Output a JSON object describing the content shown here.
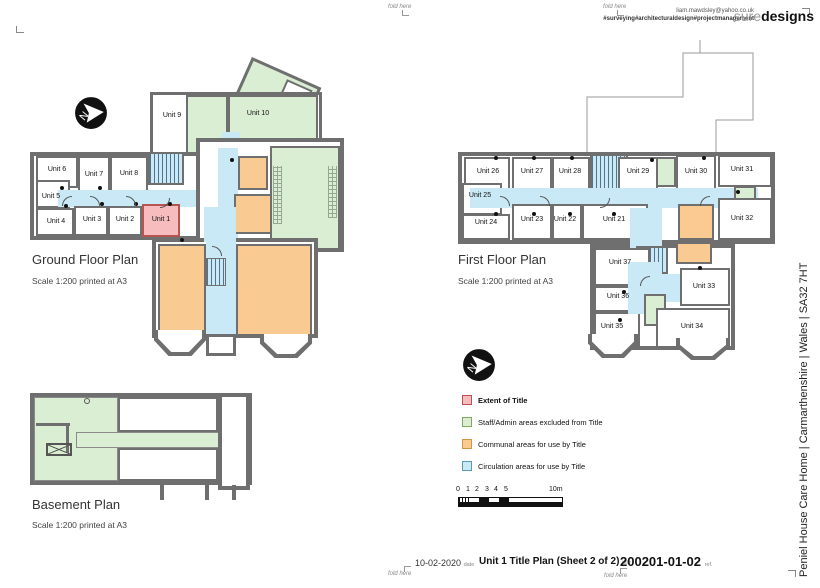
{
  "colors": {
    "wall": "#6f6f6f",
    "extent": "#f6bcbe",
    "staff_admin": "#daeed3",
    "communal": "#f9cb92",
    "circulation": "#c9e9f7"
  },
  "header": {
    "email": "liam.mawdsley@yahoo.co.uk",
    "tagline": "#surveying#architecturaldesign#projectmanagement",
    "logo_light": "sure",
    "logo_bold": "designs",
    "fold_label": "fold here"
  },
  "north_label": "N",
  "plans": {
    "ground": {
      "title": "Ground Floor Plan",
      "scale": "Scale 1:200 printed at A3",
      "units": [
        "Unit 1",
        "Unit 2",
        "Unit 3",
        "Unit 4",
        "Unit 5",
        "Unit 6",
        "Unit 7",
        "Unit 8",
        "Unit 9",
        "Unit 10"
      ]
    },
    "first": {
      "title": "First Floor Plan",
      "scale": "Scale 1:200 printed at A3",
      "units": [
        "Unit 21",
        "Unit 22",
        "Unit 23",
        "Unit 24",
        "Unit 25",
        "Unit 26",
        "Unit 27",
        "Unit 28",
        "Unit 29",
        "Unit 30",
        "Unit 31",
        "Unit 32",
        "Unit 33",
        "Unit 34",
        "Unit 35",
        "Unit 36",
        "Unit 37"
      ]
    },
    "basement": {
      "title": "Basement Plan",
      "scale": "Scale 1:200 printed at A3"
    }
  },
  "legend": {
    "items": [
      {
        "label": "Extent of Title",
        "fill": "#f6bcbe",
        "border": "#c0504d"
      },
      {
        "label": "Staff/Admin areas excluded from Title",
        "fill": "#daeed3",
        "border": "#82a860"
      },
      {
        "label": "Communal areas for use by Title",
        "fill": "#f9cb92",
        "border": "#d29544"
      },
      {
        "label": "Circulation areas for use by Title",
        "fill": "#c9e9f7",
        "border": "#5b9ab0"
      }
    ]
  },
  "scalebar": {
    "ticks": [
      "0",
      "1",
      "2",
      "3",
      "4",
      "5"
    ],
    "end_label": "10m"
  },
  "titleblock": {
    "date_value": "10-02-2020",
    "date_label": "date",
    "title_value": "Unit 1 Title Plan (Sheet 2 of 2)",
    "title_label": "title",
    "ref_value": "200201-01-02",
    "ref_label": "ref."
  },
  "project_line": "Peniel House Care Home | Carmarthenshire | Wales | SA32 7HT"
}
